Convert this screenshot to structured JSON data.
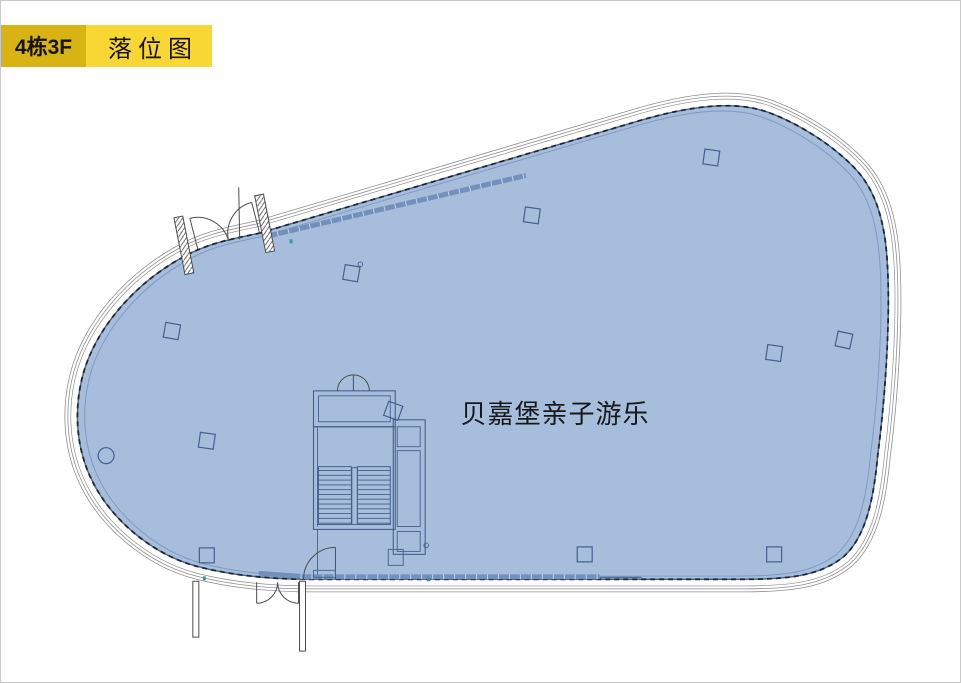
{
  "header": {
    "building_label": "4栋3F",
    "diagram_label": "落位图"
  },
  "floorplan": {
    "tenant_name": "贝嘉堡亲子游乐"
  },
  "colors": {
    "page_border": "#c9c9c9",
    "building_tag_bg": "#d7b414",
    "title_tag_bg": "#f8d633",
    "tag_text": "#181200",
    "area_fill": "#a6bedc",
    "area_edge": "#44608c",
    "area_inner_line": "#7e99c4",
    "outline_gray": "#8f8f8f",
    "dash_black": "#20262e",
    "band_blue": "#7390bd",
    "band_gap": "#c6d4e8",
    "tick_teal": "#2f9e8f",
    "tenant_text": "#16181c"
  }
}
